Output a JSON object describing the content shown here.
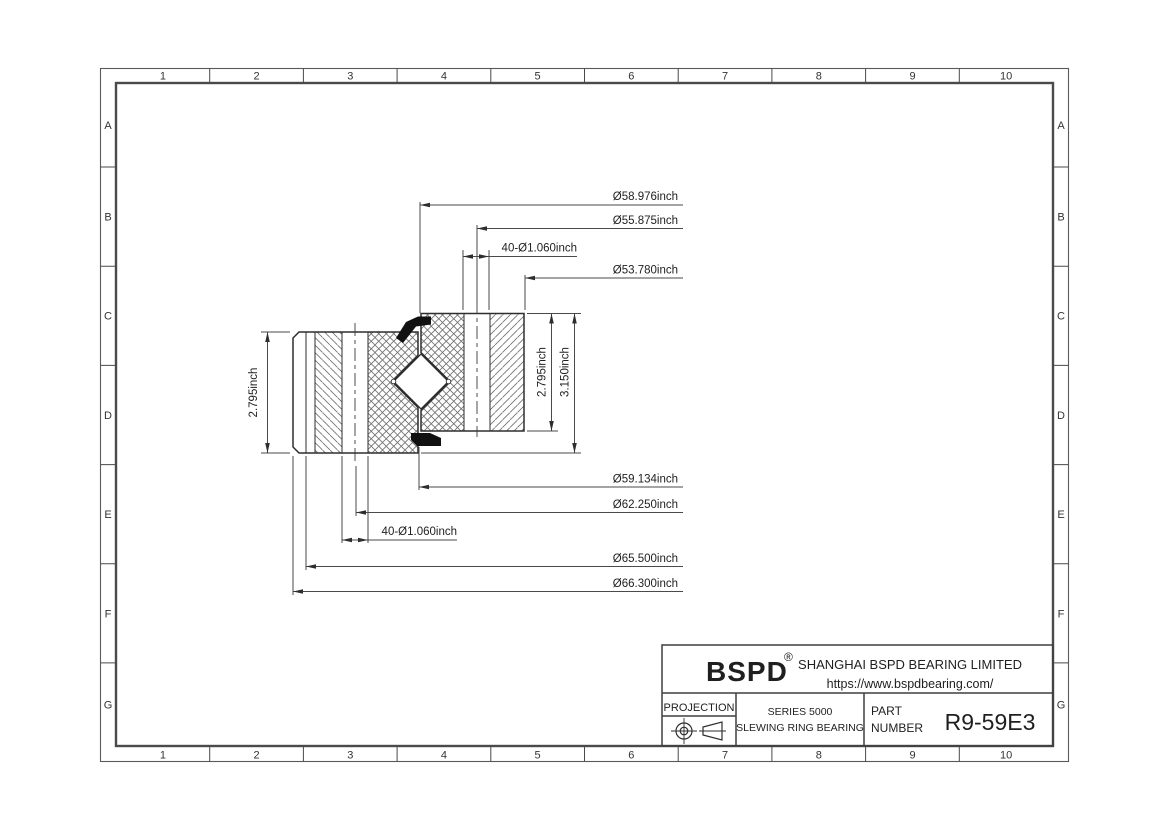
{
  "sheet": {
    "columns": [
      "1",
      "2",
      "3",
      "4",
      "5",
      "6",
      "7",
      "8",
      "9",
      "10"
    ],
    "rows": [
      "A",
      "B",
      "C",
      "D",
      "E",
      "F",
      "G"
    ]
  },
  "drawing": {
    "dims": {
      "d1": "Ø58.976inch",
      "d2": "Ø55.875inch",
      "d3": "40-Ø1.060inch",
      "d4": "Ø53.780inch",
      "d5": "Ø59.134inch",
      "d6": "Ø62.250inch",
      "d7": "40-Ø1.060inch",
      "d8": "Ø65.500inch",
      "d9": "Ø66.300inch",
      "v1": "2.795inch",
      "v2": "2.795inch",
      "v3": "3.150inch"
    }
  },
  "title_block": {
    "logo": "BSPD",
    "registered_mark": "®",
    "company": "SHANGHAI BSPD BEARING LIMITED",
    "website": "https://www.bspdbearing.com/",
    "projection_label": "PROJECTION",
    "series_line1": "SERIES 5000",
    "series_line2": "SLEWING RING BEARING",
    "part_label_line1": "PART",
    "part_label_line2": "NUMBER",
    "part_number": "R9-59E3"
  },
  "colors": {
    "line": "#2e2e2e",
    "dim_line": "#4a4a4a",
    "hatch": "#6f6f6f",
    "background": "#ffffff"
  }
}
